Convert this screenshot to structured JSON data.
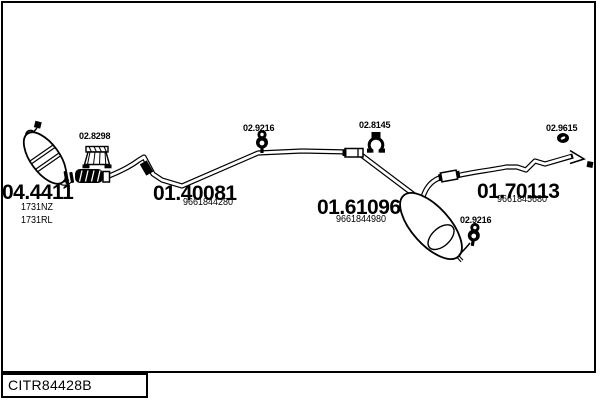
{
  "colors": {
    "ink": "#000000",
    "background": "#ffffff"
  },
  "parts": {
    "catalyst": {
      "code": "04.4411",
      "ref1": "1731NZ",
      "ref2": "1731RL"
    },
    "front_pipe": {
      "code": "01.40081",
      "ref": "9661844280"
    },
    "rear_silencer": {
      "code": "01.61096",
      "ref": "9661844980"
    },
    "tail_pipe": {
      "code": "01.70113",
      "ref": "9661845680"
    }
  },
  "clamps": {
    "bracket": {
      "code": "02.8298",
      "icon": "mounting-bracket-icon"
    },
    "hanger_front": {
      "code": "02.9216",
      "icon": "rubber-hanger-icon"
    },
    "clamp_mid": {
      "code": "02.8145",
      "icon": "pipe-clamp-icon"
    },
    "grommet_rear": {
      "code": "02.9615",
      "icon": "rubber-grommet-icon"
    },
    "hanger_rear": {
      "code": "02.9216",
      "icon": "rubber-hanger-icon"
    }
  },
  "footer": {
    "code": "CITR84428B"
  }
}
